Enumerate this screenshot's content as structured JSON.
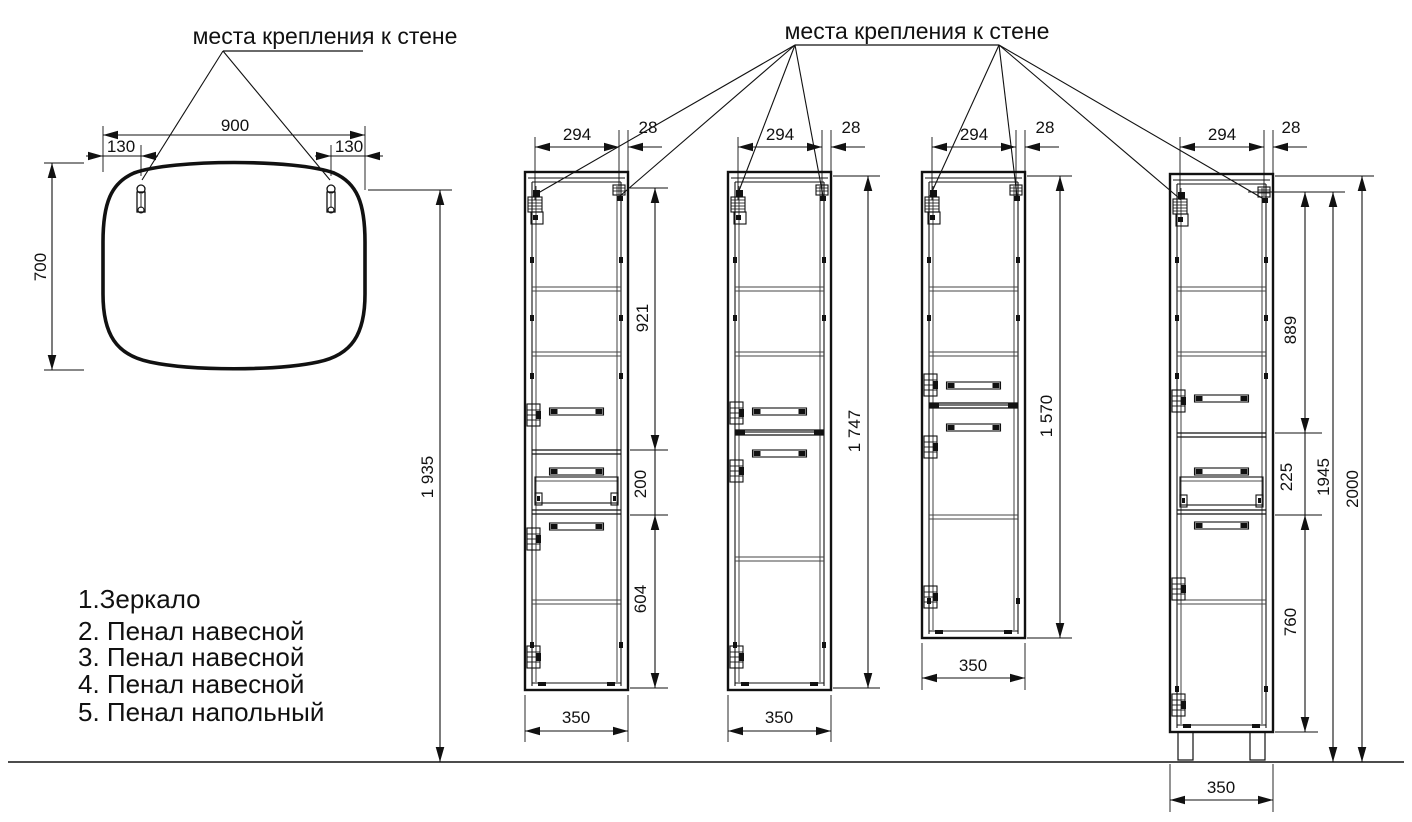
{
  "titles": {
    "left": "места крепления к стене",
    "right": "места крепления к стене"
  },
  "legend": {
    "items": [
      "1.Зеркало",
      "2. Пенал навесной",
      "3. Пенал навесной",
      "4. Пенал навесной",
      "5. Пенал напольный"
    ]
  },
  "mirror": {
    "width": "900",
    "offset_left": "130",
    "offset_right": "130",
    "height": "700",
    "hook_height_above_floor": "1 935"
  },
  "cabinet2": {
    "top_width": "294",
    "depth": "28",
    "upper_section": "921",
    "drawer_section": "200",
    "lower_section": "604",
    "bottom_width": "350"
  },
  "cabinet3": {
    "top_width": "294",
    "depth": "28",
    "total_height": "1 747",
    "bottom_width": "350"
  },
  "cabinet4": {
    "top_width": "294",
    "depth": "28",
    "total_height": "1 570",
    "bottom_width": "350"
  },
  "cabinet5": {
    "top_width": "294",
    "depth": "28",
    "upper_section": "889",
    "drawer_section": "225",
    "lower_section": "760",
    "body_height": "1945",
    "total_height": "2000",
    "bottom_width": "350"
  }
}
